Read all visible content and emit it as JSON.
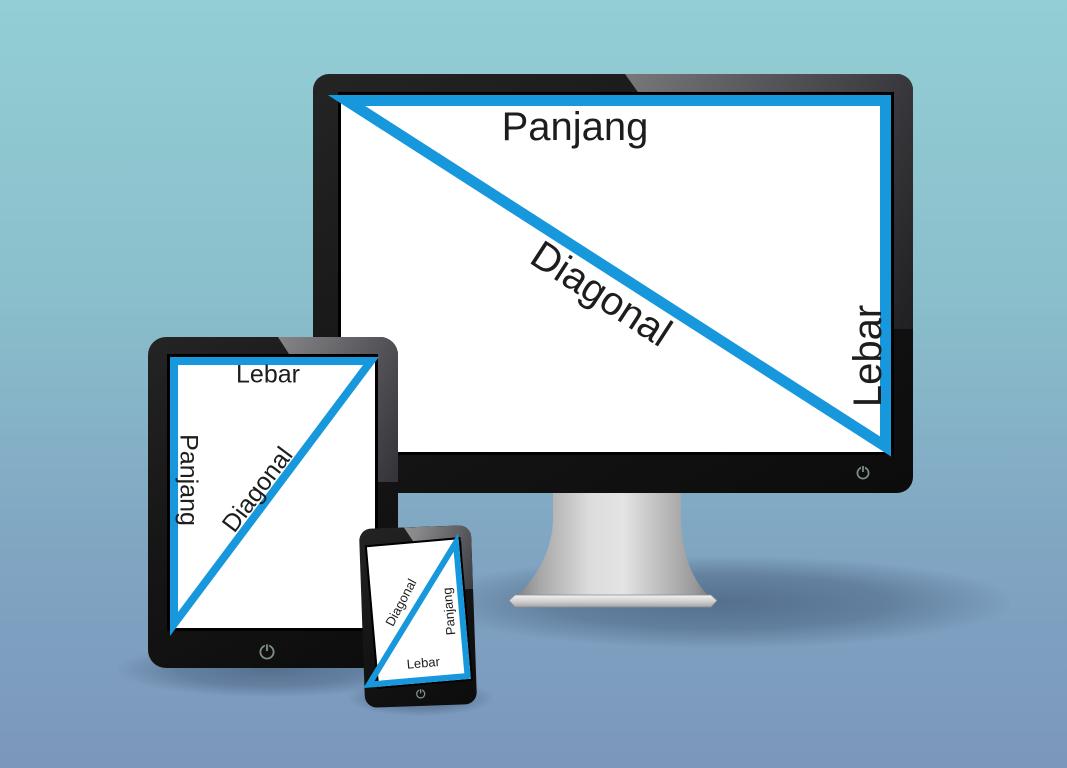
{
  "scene": {
    "title": "Screen dimension illustration (monitor, tablet, phone)"
  },
  "colors": {
    "accent-blue": "#1798dc",
    "bg-top": "#93ced4",
    "bg-bottom": "#7b97bc",
    "text-dark": "#1d1d1d",
    "power-icon": "#7f9183"
  },
  "devices": {
    "monitor": {
      "labels": {
        "top": "Panjang",
        "side": "Lebar",
        "diagonal": "Diagonal"
      },
      "power_icon": "power-icon"
    },
    "tablet": {
      "labels": {
        "top": "Lebar",
        "side": "Panjang",
        "diagonal": "Diagonal"
      },
      "power_icon": "power-icon"
    },
    "phone": {
      "labels": {
        "bottom": "Lebar",
        "side": "Panjang",
        "diagonal": "Diagonal"
      },
      "power_icon": "power-icon"
    }
  }
}
